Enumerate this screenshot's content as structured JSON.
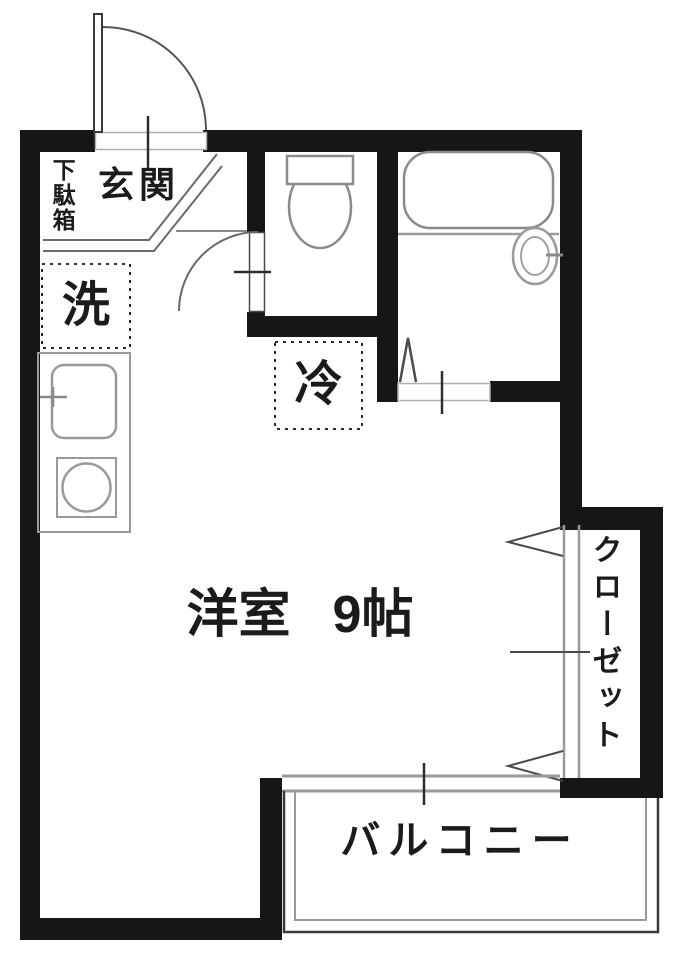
{
  "rooms": {
    "entrance": {
      "label": "玄関"
    },
    "shoe_cabinet": {
      "label": "下駄箱"
    },
    "laundry_space": {
      "label": "洗"
    },
    "refrigerator_space": {
      "label": "冷"
    },
    "western_room": {
      "name": "洋室",
      "size": "9帖"
    },
    "closet": {
      "label": "クローゼット"
    },
    "balcony": {
      "label": "バルコニー"
    }
  },
  "colors": {
    "wall": "#161616",
    "fixture_line": "#8f8f8f",
    "door_line": "#5a5a5a",
    "text": "#1b1b1b",
    "background": "#ffffff"
  },
  "icons": {
    "entrance_door": "swing-door-arc-icon",
    "toilet_door": "swing-door-arc-icon",
    "bathroom_door": "folding-door-icon",
    "closet_doors": "double-outswing-door-icon",
    "balcony_window": "sliding-window-icon",
    "bathtub": "bathtub-icon",
    "toilet": "toilet-icon",
    "wash_basin": "round-basin-icon",
    "kitchen_sink": "sink-icon",
    "stove": "burner-icon"
  }
}
